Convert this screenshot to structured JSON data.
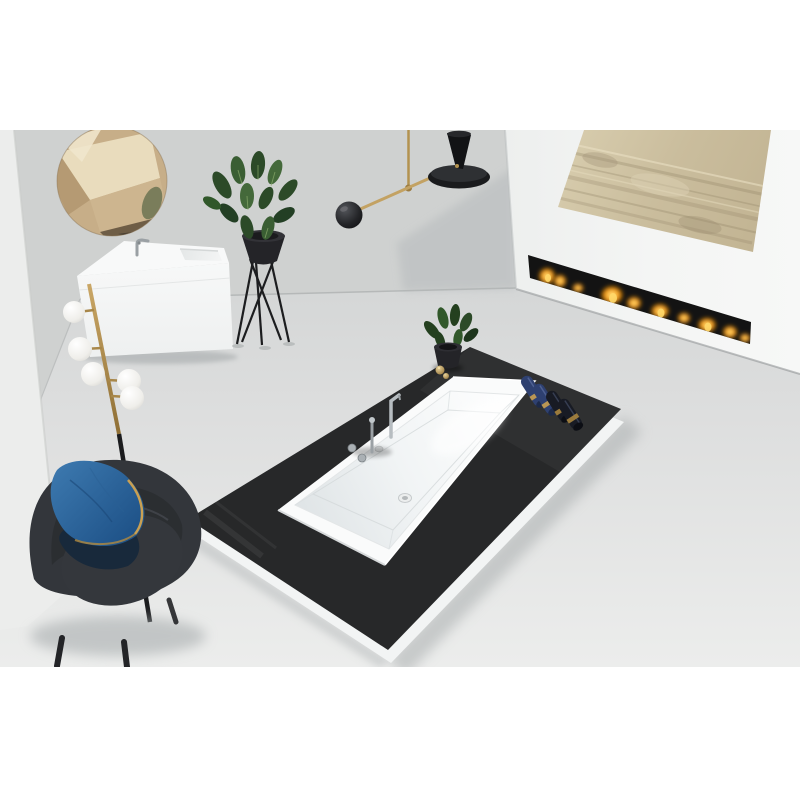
{
  "meta": {
    "title": "Minimalist bathroom interior render with black bathtub platform",
    "view": "elevated three-quarter view, scene strip on white canvas"
  },
  "palette": {
    "canvas": "#ffffff",
    "wall": "#cfd1d0",
    "wall_shadow": "#b7bbbd",
    "left_panel": "#ecedec",
    "fireplace_wall": "#f3f4f3",
    "floor_dark": "#d5d7d7",
    "floor_light": "#ebeceb",
    "art_base": "#cdc0a0",
    "art_streak": "#8e8164",
    "firebox": "#131313",
    "flame_orange": "#ee8d07",
    "flame_yellow": "#ffd24a",
    "mirror_bronze": "#c7ae88",
    "mirror_light": "#e9dcbd",
    "mirror_dark": "#6e5d46",
    "vanity_white": "#f8f9f9",
    "chrome": "#a9afb3",
    "gold": "#b08d4a",
    "gold_light": "#d9bc7e",
    "lamp_black": "#1b1c1e",
    "globe_white": "#f7f6f2",
    "plant_green": "#35562e",
    "plant_green_dark": "#24401f",
    "pot_black": "#242428",
    "platform_black": "#272829",
    "platform_white": "#f2f4f4",
    "tub_white": "#fafbfb",
    "towel_navy": "#2e4070",
    "towel_black": "#181b24",
    "towel_band": "#c29b52",
    "pillow_blue": "#2a6096",
    "pillow_navy": "#18293b",
    "chair_charcoal": "#33363b",
    "shadow_gray": "#a2a7a9"
  },
  "scene": {
    "description": "Minimalist bathroom: black bath platform with white drop-in tub, linear fireplace, round bronze mirror, white floating vanity, brass lamps, plants, gray armchair with blue pillow",
    "objects": {
      "mirror": {
        "shape": "round",
        "finish": "bronze faceted glass"
      },
      "vanity": {
        "type": "wall-hung washbasin cabinet",
        "color": "white",
        "faucet": "chrome mixer"
      },
      "floor_plant": {
        "stand": "black hairpin-leg stand",
        "pot": "black",
        "foliage": "striped green leaves"
      },
      "floor_lamp": {
        "stem": "brass upper, black lower",
        "globe_count": 5
      },
      "pendant_lamp": {
        "finish": "brass",
        "counterweight": "black sphere",
        "shade": "black disc with cone"
      },
      "artwork": {
        "style": "abstract gold-leaf panel"
      },
      "fireplace": {
        "type": "built-in linear fire line",
        "flames": "row of small gas flames"
      },
      "platform": {
        "top": "matte black slab",
        "base": "white plinth"
      },
      "bathtub": {
        "type": "rectangular drop-in",
        "color": "white",
        "drain": "center",
        "overflow": true
      },
      "bath_faucet": {
        "finish": "chrome",
        "handle_count": 2
      },
      "towels": {
        "navy_count": 2,
        "dark_count": 2,
        "band": "gold label"
      },
      "deck_plant": {
        "pot": "black",
        "accessory": "gold ornament"
      },
      "armchair": {
        "upholstery": "dark gray fabric",
        "legs": "black",
        "pillow": "blue with gold piping and navy underside"
      }
    }
  }
}
